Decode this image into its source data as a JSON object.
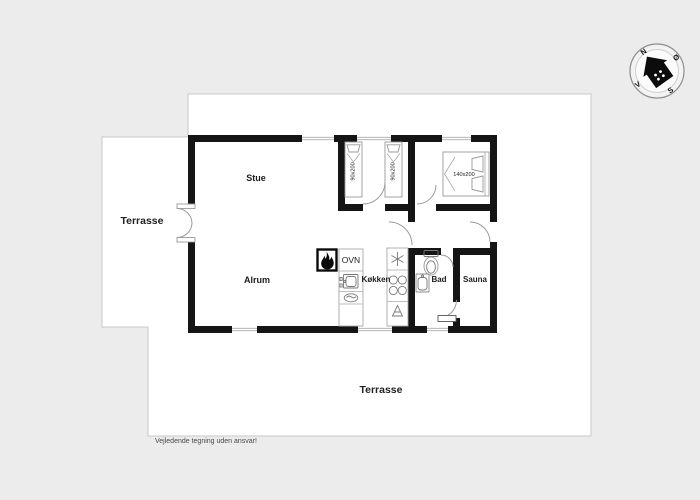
{
  "labels": {
    "terrace_left": "Terrasse",
    "terrace_bottom": "Terrasse",
    "stue": "Stue",
    "alrum": "Alrum",
    "kokken": "Køkken",
    "bad": "Bad",
    "sauna": "Sauna",
    "ovn": "OVN"
  },
  "beds": {
    "single1": "90x200",
    "single2": "90x200",
    "double": "140x200"
  },
  "compass": {
    "north": "N",
    "east": "Ø",
    "south": "S",
    "west": "V"
  },
  "disclaimer": "Vejledende tegning uden ansvar!",
  "colors": {
    "background": "#ececec",
    "terrace": "#ffffff",
    "wall": "#151515",
    "outline": "#c9c9c9"
  }
}
